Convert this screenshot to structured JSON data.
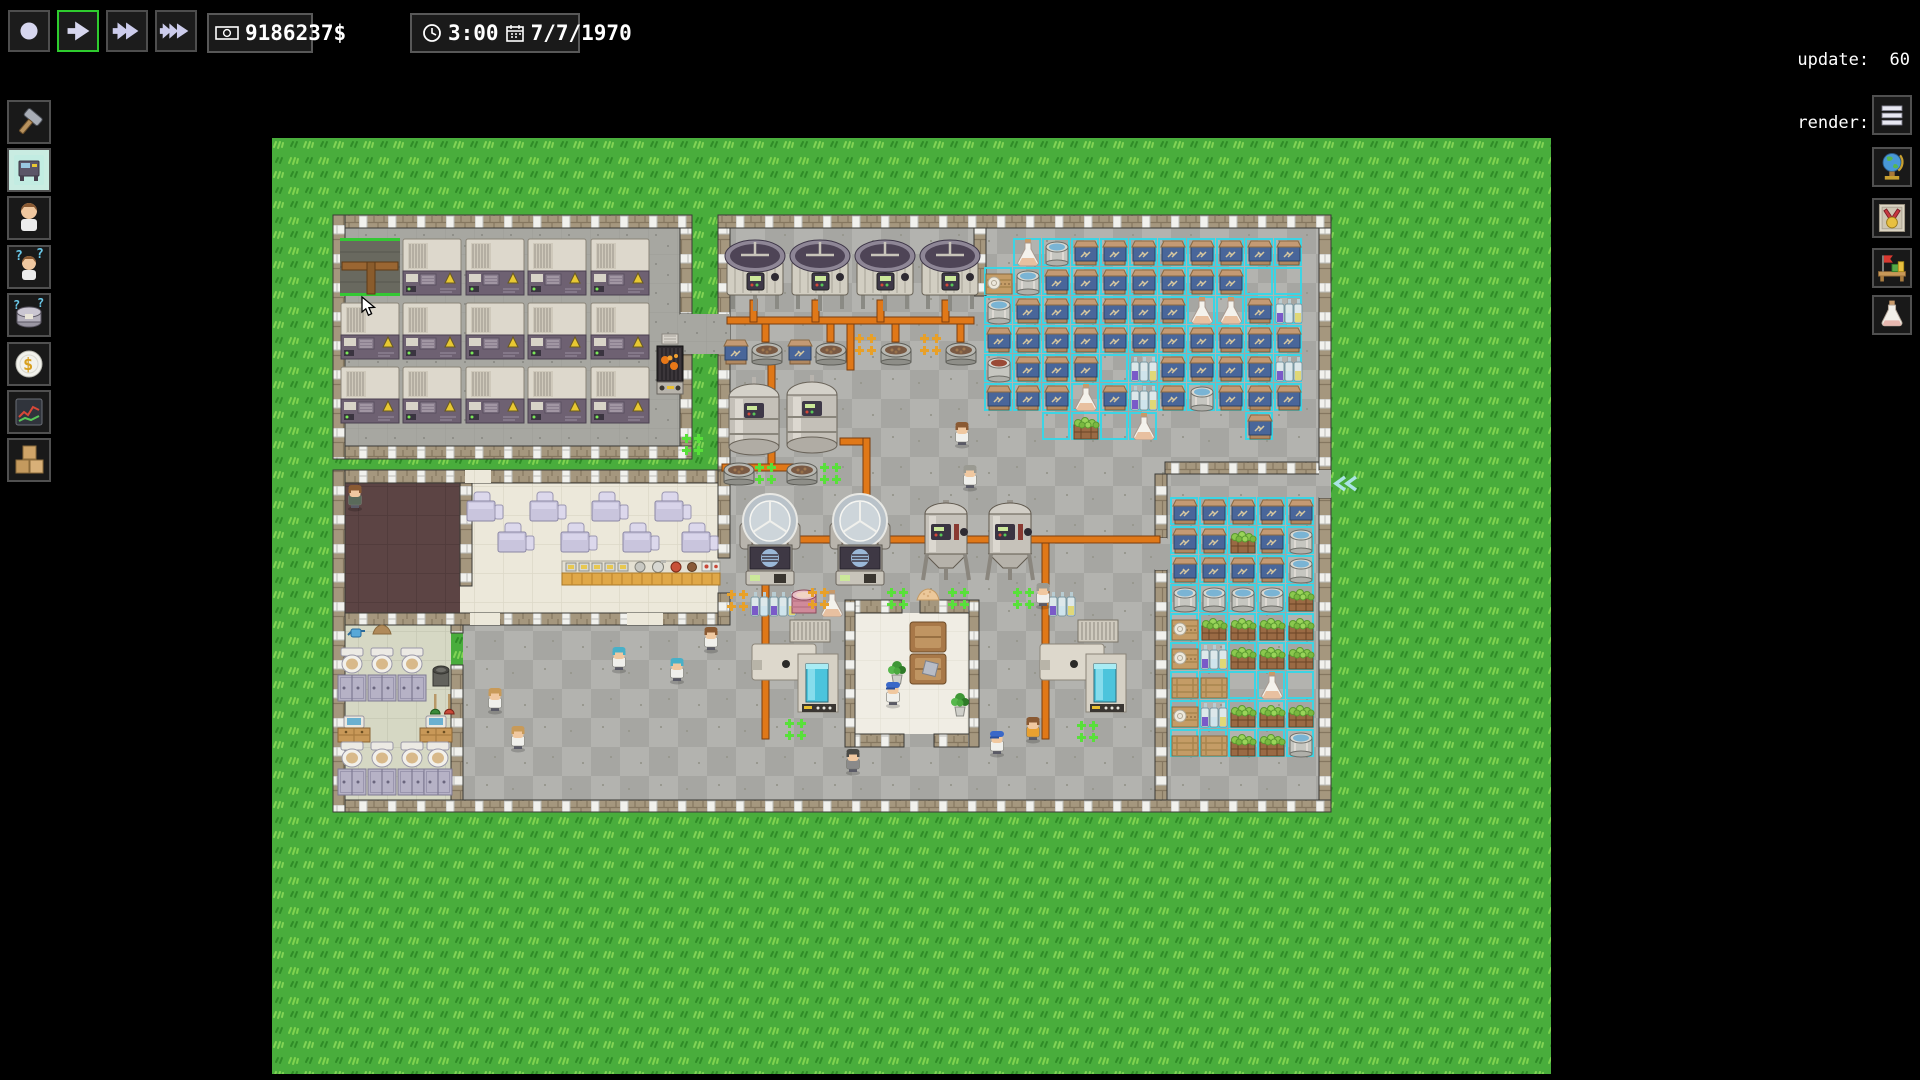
{
  "hud": {
    "update_line": "update:  60",
    "render_line": "render: 639",
    "money": "9186237$",
    "time": "3:00",
    "date": "7/7/1970"
  },
  "toolbar_buttons": [
    {
      "icon": "stop",
      "selected": false
    },
    {
      "icon": "play",
      "selected": true
    },
    {
      "icon": "ffwd",
      "selected": false
    },
    {
      "icon": "fffwd",
      "selected": false
    }
  ],
  "sidebar_left": [
    {
      "icon": "hammer",
      "selected": false
    },
    {
      "icon": "machine",
      "selected": true
    },
    {
      "icon": "worker",
      "selected": false
    },
    {
      "icon": "worker-question",
      "selected": false
    },
    {
      "icon": "tank-question",
      "selected": false
    },
    {
      "icon": "coin",
      "selected": false
    },
    {
      "icon": "chart",
      "selected": false
    },
    {
      "icon": "boxes",
      "selected": false
    }
  ],
  "sidebar_right": [
    {
      "icon": "menu"
    },
    {
      "icon": "globe"
    },
    {
      "icon": "medal"
    },
    {
      "icon": "desk"
    },
    {
      "icon": "flask"
    }
  ],
  "palette": {
    "accent_green": "#2ecc2e",
    "select_cyan": "#3cd4e4",
    "pipe_orange": "#e07818",
    "grass_base": "#49ad3c",
    "warn_yellow": "#e8c832"
  },
  "map": {
    "floors": [
      {
        "x": 61,
        "y": 77,
        "w": 359,
        "h": 244,
        "p": "machine"
      },
      {
        "x": 446,
        "y": 77,
        "w": 613,
        "h": 597,
        "p": "checker"
      },
      {
        "x": 191,
        "y": 487,
        "w": 255,
        "h": 187,
        "p": "checker"
      },
      {
        "x": 61,
        "y": 332,
        "w": 385,
        "h": 155,
        "p": "cream"
      },
      {
        "x": 73,
        "y": 345,
        "w": 115,
        "h": 130,
        "p": "dark"
      },
      {
        "x": 73,
        "y": 487,
        "w": 106,
        "h": 175,
        "p": "bath"
      },
      {
        "x": 583,
        "y": 475,
        "w": 114,
        "h": 121,
        "p": "lounge"
      }
    ],
    "wallsH": [
      {
        "x": 61,
        "y": 77,
        "w": 359,
        "h": 13
      },
      {
        "x": 61,
        "y": 308,
        "w": 359,
        "h": 13
      },
      {
        "x": 446,
        "y": 77,
        "w": 613,
        "h": 13
      },
      {
        "x": 61,
        "y": 662,
        "w": 998,
        "h": 12
      },
      {
        "x": 61,
        "y": 332,
        "w": 385,
        "h": 13
      },
      {
        "x": 61,
        "y": 475,
        "w": 385,
        "h": 12
      },
      {
        "x": 893,
        "y": 324,
        "w": 166,
        "h": 12
      },
      {
        "x": 576,
        "y": 462,
        "w": 54,
        "h": 13
      },
      {
        "x": 648,
        "y": 462,
        "w": 54,
        "h": 13
      },
      {
        "x": 576,
        "y": 596,
        "w": 56,
        "h": 13
      },
      {
        "x": 662,
        "y": 596,
        "w": 40,
        "h": 13
      }
    ],
    "wallsV": [
      {
        "x": 61,
        "y": 77,
        "w": 12,
        "h": 244
      },
      {
        "x": 408,
        "y": 90,
        "w": 12,
        "h": 86
      },
      {
        "x": 408,
        "y": 216,
        "w": 12,
        "h": 92
      },
      {
        "x": 61,
        "y": 332,
        "w": 12,
        "h": 342
      },
      {
        "x": 446,
        "y": 90,
        "w": 12,
        "h": 242
      },
      {
        "x": 446,
        "y": 332,
        "w": 12,
        "h": 88
      },
      {
        "x": 446,
        "y": 455,
        "w": 12,
        "h": 32
      },
      {
        "x": 1047,
        "y": 90,
        "w": 12,
        "h": 242
      },
      {
        "x": 1047,
        "y": 360,
        "w": 12,
        "h": 302
      },
      {
        "x": 188,
        "y": 345,
        "w": 12,
        "h": 103
      },
      {
        "x": 179,
        "y": 487,
        "w": 12,
        "h": 8
      },
      {
        "x": 179,
        "y": 527,
        "w": 12,
        "h": 135
      },
      {
        "x": 573,
        "y": 462,
        "w": 10,
        "h": 147
      },
      {
        "x": 697,
        "y": 462,
        "w": 10,
        "h": 147
      },
      {
        "x": 702,
        "y": 90,
        "w": 12,
        "h": 68
      },
      {
        "x": 883,
        "y": 336,
        "w": 12,
        "h": 64
      },
      {
        "x": 883,
        "y": 432,
        "w": 12,
        "h": 230
      }
    ],
    "gapFills": [
      {
        "x": 408,
        "y": 176,
        "w": 50,
        "h": 40,
        "p": "machine"
      },
      {
        "x": 193,
        "y": 332,
        "w": 26,
        "h": 13,
        "p": "cream"
      },
      {
        "x": 198,
        "y": 475,
        "w": 30,
        "h": 12,
        "p": "cream"
      },
      {
        "x": 355,
        "y": 475,
        "w": 36,
        "h": 12,
        "p": "cream"
      },
      {
        "x": 1047,
        "y": 332,
        "w": 12,
        "h": 28,
        "p": "checker"
      },
      {
        "x": 883,
        "y": 400,
        "w": 12,
        "h": 32,
        "p": "checker"
      }
    ],
    "pipes": [
      {
        "x": 455,
        "y": 179,
        "w": 247,
        "h": 7
      },
      {
        "x": 478,
        "y": 162,
        "w": 7,
        "h": 22
      },
      {
        "x": 540,
        "y": 162,
        "w": 7,
        "h": 22
      },
      {
        "x": 605,
        "y": 162,
        "w": 7,
        "h": 22
      },
      {
        "x": 670,
        "y": 162,
        "w": 7,
        "h": 22
      },
      {
        "x": 490,
        "y": 186,
        "w": 7,
        "h": 18
      },
      {
        "x": 555,
        "y": 186,
        "w": 7,
        "h": 18
      },
      {
        "x": 620,
        "y": 186,
        "w": 7,
        "h": 18
      },
      {
        "x": 685,
        "y": 186,
        "w": 7,
        "h": 18
      },
      {
        "x": 575,
        "y": 186,
        "w": 7,
        "h": 46
      },
      {
        "x": 496,
        "y": 226,
        "w": 7,
        "h": 100
      },
      {
        "x": 450,
        "y": 326,
        "w": 80,
        "h": 7
      },
      {
        "x": 568,
        "y": 300,
        "w": 30,
        "h": 7
      },
      {
        "x": 591,
        "y": 300,
        "w": 7,
        "h": 102
      },
      {
        "x": 468,
        "y": 398,
        "w": 420,
        "h": 7
      },
      {
        "x": 490,
        "y": 405,
        "w": 7,
        "h": 196
      },
      {
        "x": 770,
        "y": 405,
        "w": 7,
        "h": 196
      }
    ],
    "zones": [
      {
        "x": 712,
        "y": 100,
        "ts": 29,
        "grid": [
          ".FWSSSSSSSS",
          "PWSSSSSSSxx",
          "WSSSSSSFFSb",
          "SSSSSSSSSSS",
          "DSSSxbSSSSb",
          "SSSFSbSWSSS",
          "..xHxF...S."
        ]
      },
      {
        "x": 898,
        "y": 359,
        "ts": 29,
        "grid": [
          "SSSSS",
          "SSHSW",
          "SSSSW",
          "WWWWH",
          "PHHHH",
          "PbHHH",
          "ssxFx",
          "PbHHH",
          "ssHHW"
        ]
      }
    ],
    "objects": [
      {
        "t": "selecttile",
        "x": 68,
        "y": 100
      },
      {
        "t": "machine",
        "x": 130,
        "y": 100
      },
      {
        "t": "machine",
        "x": 193,
        "y": 100
      },
      {
        "t": "machine",
        "x": 255,
        "y": 100
      },
      {
        "t": "machine",
        "x": 318,
        "y": 100
      },
      {
        "t": "machine",
        "x": 68,
        "y": 164
      },
      {
        "t": "machine",
        "x": 130,
        "y": 164
      },
      {
        "t": "machine",
        "x": 193,
        "y": 164
      },
      {
        "t": "machine",
        "x": 255,
        "y": 164
      },
      {
        "t": "machine",
        "x": 318,
        "y": 164
      },
      {
        "t": "machine",
        "x": 68,
        "y": 228
      },
      {
        "t": "machine",
        "x": 130,
        "y": 228
      },
      {
        "t": "machine",
        "x": 193,
        "y": 228
      },
      {
        "t": "machine",
        "x": 255,
        "y": 228
      },
      {
        "t": "machine",
        "x": 318,
        "y": 228
      },
      {
        "t": "furnace",
        "x": 384,
        "y": 196
      },
      {
        "t": "vat",
        "x": 451,
        "y": 97
      },
      {
        "t": "vat",
        "x": 516,
        "y": 97
      },
      {
        "t": "vat",
        "x": 581,
        "y": 97
      },
      {
        "t": "vat",
        "x": 646,
        "y": 97
      },
      {
        "t": "sack",
        "x": 450,
        "y": 200
      },
      {
        "t": "basin",
        "x": 479,
        "y": 202
      },
      {
        "t": "sack",
        "x": 514,
        "y": 200
      },
      {
        "t": "basin",
        "x": 543,
        "y": 202
      },
      {
        "t": "basin",
        "x": 608,
        "y": 202
      },
      {
        "t": "basin",
        "x": 673,
        "y": 202
      },
      {
        "t": "fermenter",
        "x": 455,
        "y": 239
      },
      {
        "t": "fermenter",
        "x": 513,
        "y": 237
      },
      {
        "t": "basin",
        "x": 451,
        "y": 322
      },
      {
        "t": "basin",
        "x": 514,
        "y": 322
      },
      {
        "t": "centrifuge",
        "x": 468,
        "y": 355
      },
      {
        "t": "centrifuge",
        "x": 558,
        "y": 355
      },
      {
        "t": "conical",
        "x": 645,
        "y": 362
      },
      {
        "t": "conical",
        "x": 709,
        "y": 362
      },
      {
        "t": "bottles",
        "x": 478,
        "y": 452
      },
      {
        "t": "bottles",
        "x": 497,
        "y": 452
      },
      {
        "t": "drumpink",
        "x": 518,
        "y": 449
      },
      {
        "t": "flask",
        "x": 546,
        "y": 452
      },
      {
        "t": "mound",
        "x": 643,
        "y": 449
      },
      {
        "t": "bottles",
        "x": 776,
        "y": 452
      },
      {
        "t": "packer",
        "x": 480,
        "y": 482
      },
      {
        "t": "packer",
        "x": 768,
        "y": 482
      },
      {
        "t": "couch",
        "x": 638,
        "y": 484
      },
      {
        "t": "couch",
        "x": 638,
        "y": 516
      },
      {
        "t": "pillow",
        "x": 652,
        "y": 524
      },
      {
        "t": "plant",
        "x": 615,
        "y": 520
      },
      {
        "t": "plant",
        "x": 678,
        "y": 552
      },
      {
        "t": "table",
        "x": 195,
        "y": 354
      },
      {
        "t": "table",
        "x": 258,
        "y": 354
      },
      {
        "t": "table",
        "x": 320,
        "y": 354
      },
      {
        "t": "table",
        "x": 383,
        "y": 354
      },
      {
        "t": "table",
        "x": 226,
        "y": 385
      },
      {
        "t": "table",
        "x": 289,
        "y": 385
      },
      {
        "t": "table",
        "x": 351,
        "y": 385
      },
      {
        "t": "table",
        "x": 410,
        "y": 385
      },
      {
        "t": "counter",
        "x": 290,
        "y": 423
      },
      {
        "t": "toilet",
        "x": 66,
        "y": 510
      },
      {
        "t": "toilet",
        "x": 96,
        "y": 510
      },
      {
        "t": "toilet",
        "x": 126,
        "y": 510
      },
      {
        "t": "stall",
        "x": 66,
        "y": 537
      },
      {
        "t": "stall",
        "x": 96,
        "y": 537
      },
      {
        "t": "stall",
        "x": 126,
        "y": 537
      },
      {
        "t": "sink",
        "x": 66,
        "y": 578
      },
      {
        "t": "sink",
        "x": 148,
        "y": 578
      },
      {
        "t": "bin",
        "x": 158,
        "y": 524
      },
      {
        "t": "plungerG",
        "x": 158,
        "y": 556
      },
      {
        "t": "plungerR",
        "x": 172,
        "y": 556
      },
      {
        "t": "toilet",
        "x": 66,
        "y": 604
      },
      {
        "t": "toilet",
        "x": 96,
        "y": 604
      },
      {
        "t": "toilet",
        "x": 126,
        "y": 604
      },
      {
        "t": "toilet",
        "x": 152,
        "y": 604
      },
      {
        "t": "stall",
        "x": 66,
        "y": 631
      },
      {
        "t": "stall",
        "x": 96,
        "y": 631
      },
      {
        "t": "stall",
        "x": 126,
        "y": 631
      },
      {
        "t": "stall",
        "x": 152,
        "y": 631
      },
      {
        "t": "can",
        "x": 76,
        "y": 487
      },
      {
        "t": "dirt",
        "x": 100,
        "y": 485
      },
      {
        "t": "arrowcyan",
        "x": 1061,
        "y": 338
      }
    ],
    "workers": [
      {
        "x": 73,
        "y": 346,
        "hair": "brown",
        "shirt": "#5a6a5a"
      },
      {
        "x": 680,
        "y": 283,
        "hair": "brown",
        "shirt": "#f0f0ec"
      },
      {
        "x": 688,
        "y": 326,
        "hair": "grey",
        "shirt": "#f0f0ec"
      },
      {
        "x": 429,
        "y": 488,
        "hair": "brown",
        "shirt": "#f0f0ec"
      },
      {
        "x": 337,
        "y": 508,
        "hair": "blue",
        "shirt": "#f0f0ec"
      },
      {
        "x": 395,
        "y": 519,
        "hair": "blue",
        "shirt": "#f0f0ec"
      },
      {
        "x": 213,
        "y": 549,
        "hair": "blond",
        "shirt": "#f0f0ec"
      },
      {
        "x": 236,
        "y": 587,
        "hair": "blond",
        "shirt": "#f0f0ec"
      },
      {
        "x": 611,
        "y": 543,
        "hair": "cap",
        "shirt": "#f0f0ec"
      },
      {
        "x": 715,
        "y": 592,
        "hair": "cap",
        "shirt": "#f0f0ec"
      },
      {
        "x": 751,
        "y": 578,
        "hair": "brown",
        "shirt": "#e8a030"
      },
      {
        "x": 761,
        "y": 444,
        "hair": "grey",
        "shirt": "#f0f0ec"
      },
      {
        "x": 571,
        "y": 610,
        "hair": "dark",
        "shirt": "#8a8a8a"
      }
    ],
    "markers": [
      {
        "x": 483,
        "y": 325,
        "c": "green"
      },
      {
        "x": 548,
        "y": 325,
        "c": "green"
      },
      {
        "x": 615,
        "y": 450,
        "c": "green"
      },
      {
        "x": 676,
        "y": 450,
        "c": "green"
      },
      {
        "x": 741,
        "y": 450,
        "c": "green"
      },
      {
        "x": 513,
        "y": 581,
        "c": "green"
      },
      {
        "x": 805,
        "y": 583,
        "c": "green"
      },
      {
        "x": 410,
        "y": 296,
        "c": "green"
      },
      {
        "x": 583,
        "y": 196,
        "c": "orange"
      },
      {
        "x": 648,
        "y": 196,
        "c": "orange"
      },
      {
        "x": 455,
        "y": 452,
        "c": "orange"
      },
      {
        "x": 536,
        "y": 450,
        "c": "orange"
      }
    ],
    "cursor": {
      "x": 89,
      "y": 158
    }
  }
}
